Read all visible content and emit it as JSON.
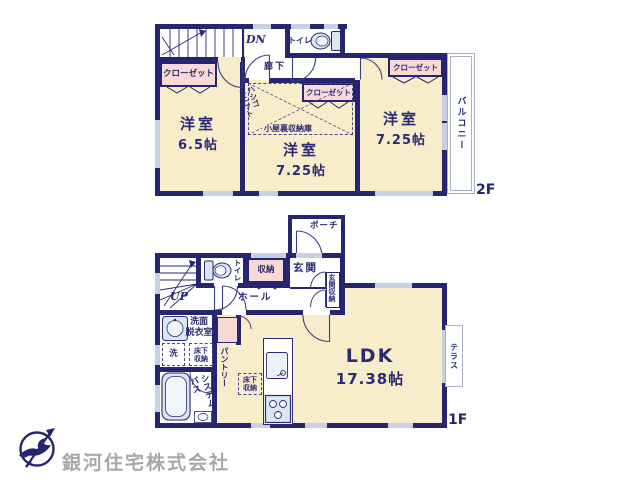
{
  "floor2": {
    "floor_label": "2F",
    "stairs_label": "DN",
    "corridor_label": "廊下",
    "toilet_label": "トイレ",
    "closet_left_label": "クローゼット",
    "closet_mid_label": "クローゼット",
    "closet_right_label": "クローゼット",
    "attic_label": "小屋裏収納庫",
    "ladder_l1": "ハシゴ",
    "ladder_l2": "ユニット",
    "balcony_label": "バルコニー",
    "room_left_name": "洋室",
    "room_left_size": "6.5帖",
    "room_mid_name": "洋室",
    "room_mid_size": "7.25帖",
    "room_right_name": "洋室",
    "room_right_size": "7.25帖"
  },
  "floor1": {
    "floor_label": "1F",
    "stairs_label": "UP",
    "porch_label": "ポーチ",
    "entrance_label": "玄関",
    "entrance_storage_label": "玄関収納",
    "storage_label": "収納",
    "toilet_label": "トイレ",
    "hall_label": "ホール",
    "washroom_l1": "洗面",
    "washroom_l2": "脱衣室",
    "washer_label": "洗",
    "underfloor_l1": "床下",
    "underfloor_l2": "収納",
    "bath_l1": "システム",
    "bath_l2": "バス",
    "pantry_label": "パントリー",
    "ldk_name": "LDK",
    "ldk_size": "17.38帖",
    "terrace_label": "テラス"
  },
  "branding": {
    "company_name": "銀河住宅株式会社"
  },
  "colors": {
    "wall": "#26256f",
    "floor": "#f8edcb",
    "closet_fill": "#f8d9d6",
    "fixture_fill": "#d9e6f4",
    "window_marker": "#c7d1e2",
    "label_text": "#2b2a72",
    "company_text": "#a8a8a8"
  }
}
